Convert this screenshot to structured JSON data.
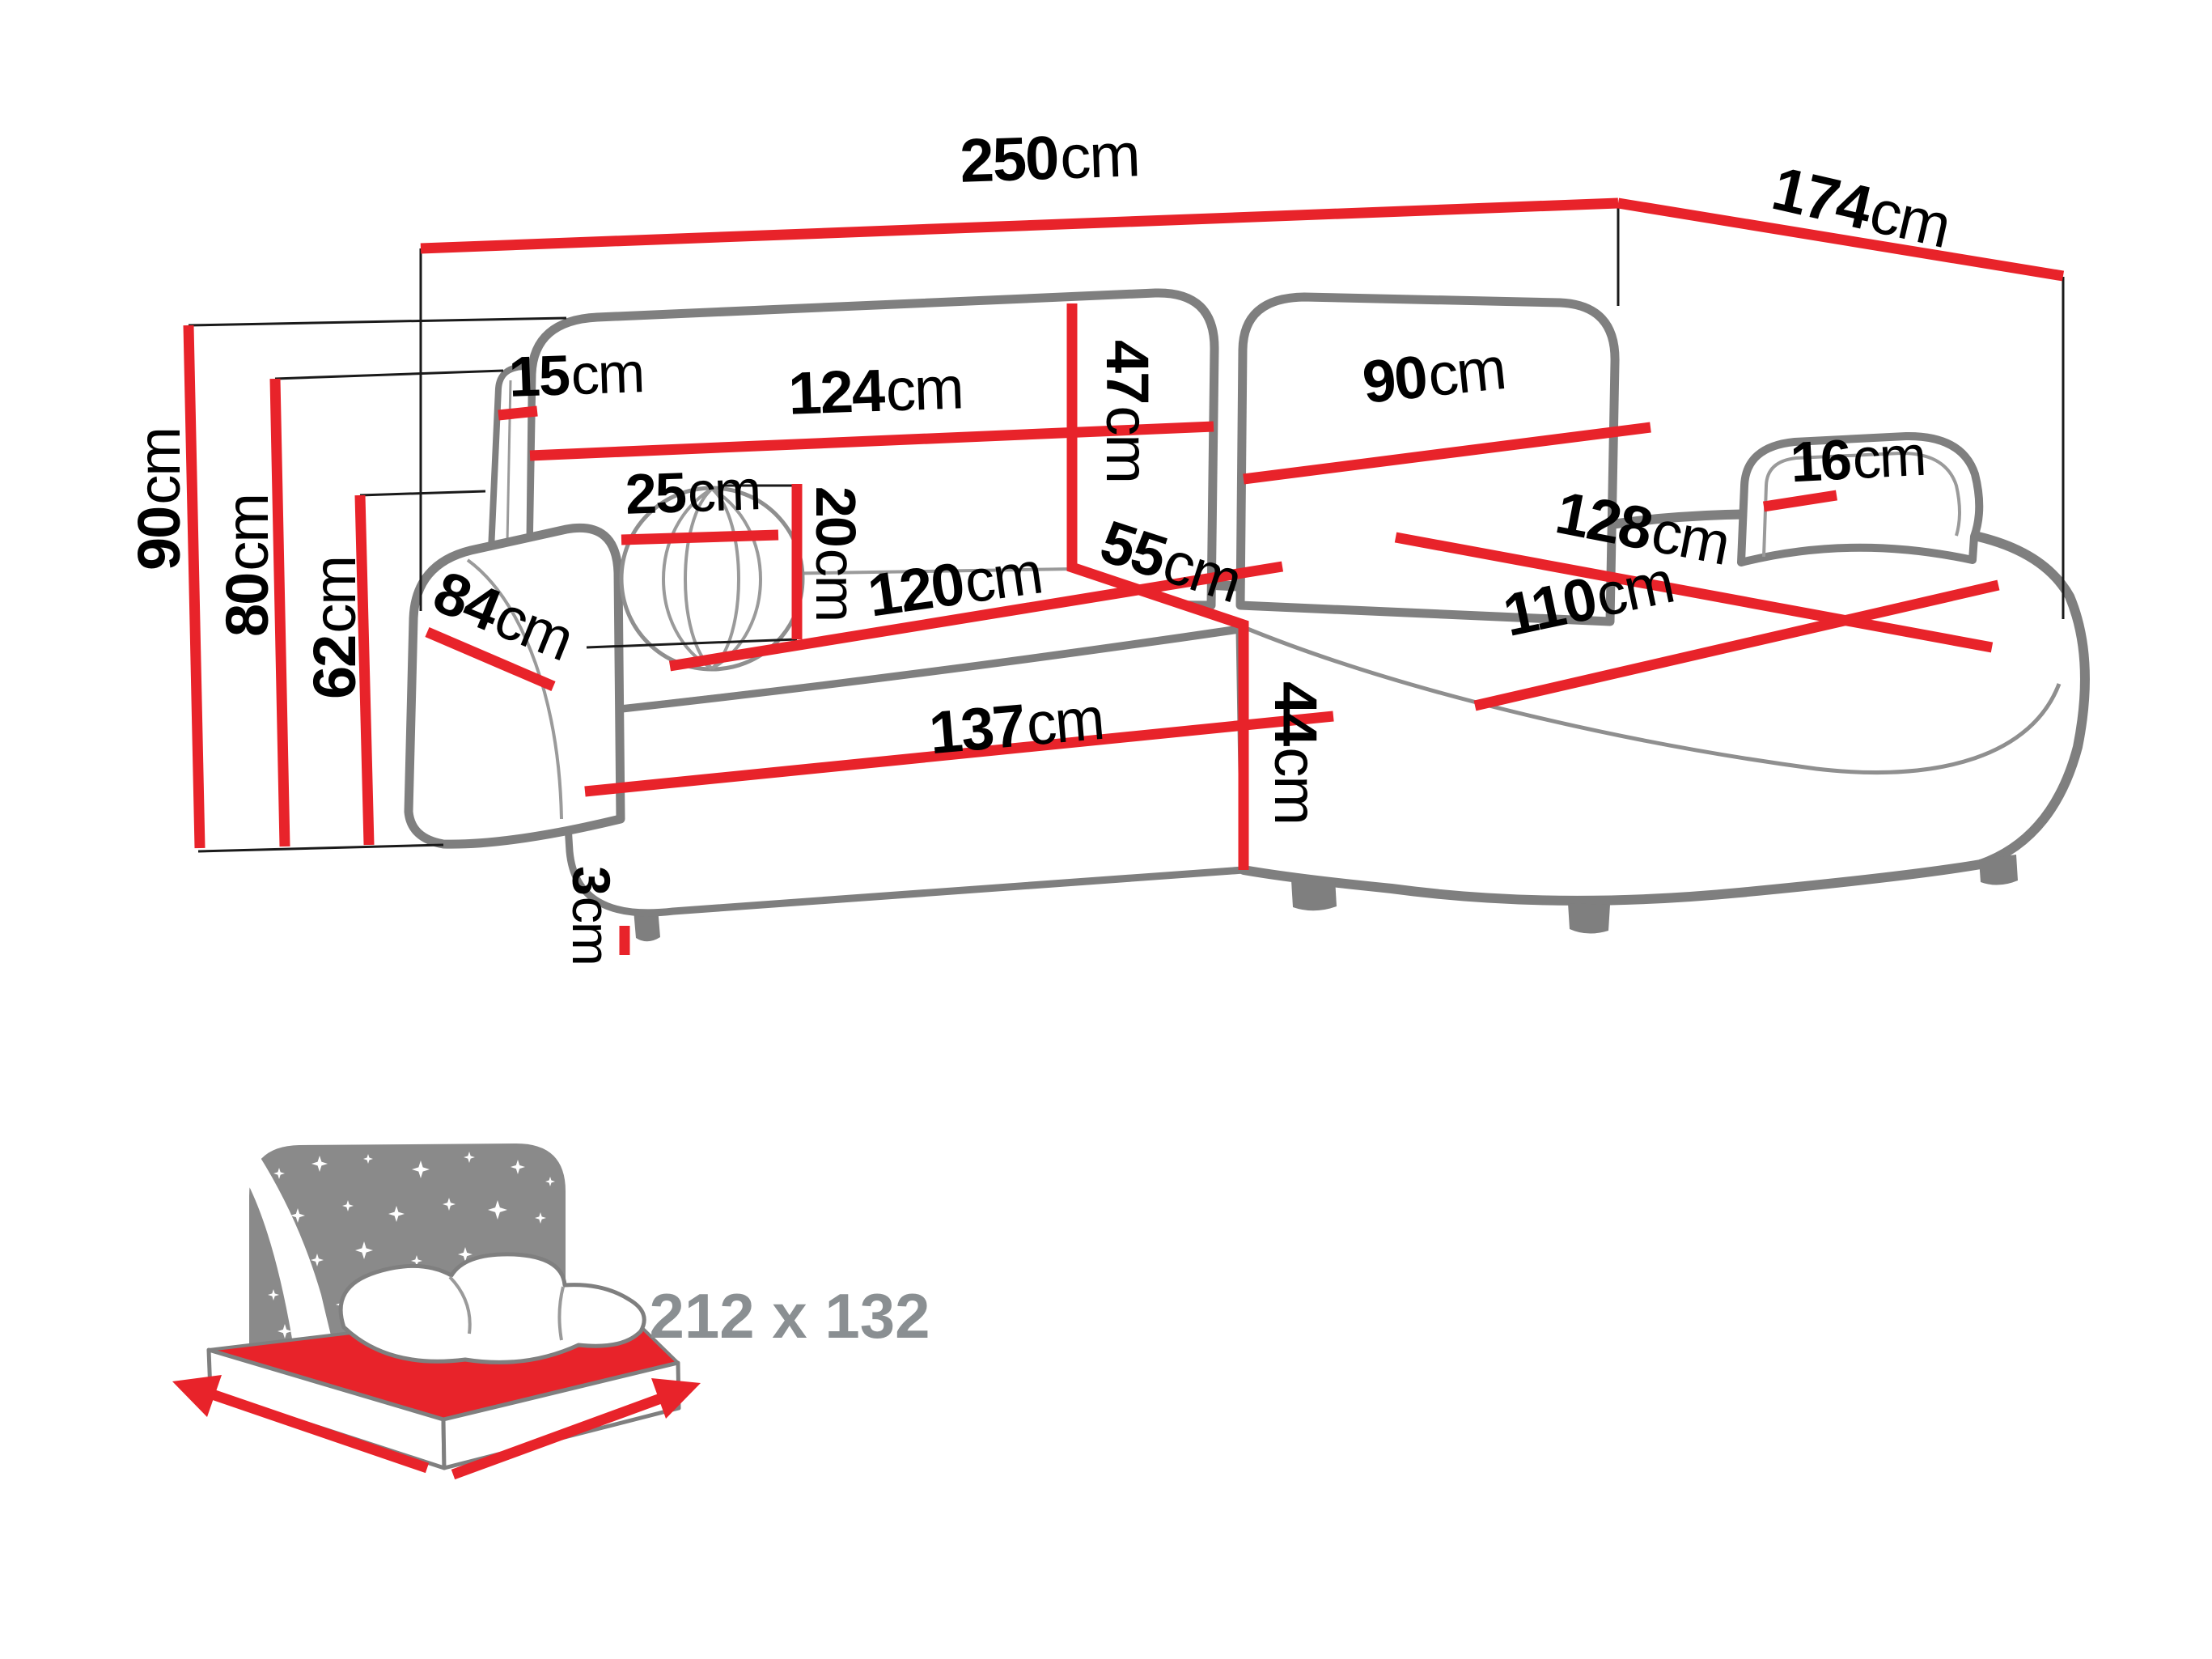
{
  "diagram_title": "corner-sofa-dimension-diagram",
  "colors": {
    "dimension_red": "#e8232a",
    "outline_gray": "#7f7f7f",
    "icon_gray": "#8a8a8a",
    "text_black": "#000000",
    "sleep_text_gray": "#8a8f92"
  },
  "dims": {
    "overall_width": {
      "value": "250",
      "unit": "cm"
    },
    "overall_depth": {
      "value": "174",
      "unit": "cm"
    },
    "total_height": {
      "value": "90",
      "unit": "cm"
    },
    "backrest_height": {
      "value": "80",
      "unit": "cm"
    },
    "armrest_height": {
      "value": "62",
      "unit": "cm"
    },
    "headrest_width": {
      "value": "15",
      "unit": "cm"
    },
    "backrest_left_width": {
      "value": "124",
      "unit": "cm"
    },
    "backrest_inner_height": {
      "value": "47",
      "unit": "cm"
    },
    "backrest_right_width": {
      "value": "90",
      "unit": "cm"
    },
    "armrest_right_width": {
      "value": "16",
      "unit": "cm"
    },
    "pillow_diameter": {
      "value": "25",
      "unit": "cm"
    },
    "pillow_height": {
      "value": "20",
      "unit": "cm"
    },
    "seat_width_left": {
      "value": "120",
      "unit": "cm"
    },
    "corner_seat_depth": {
      "value": "55",
      "unit": "cm"
    },
    "chaise_length": {
      "value": "128",
      "unit": "cm"
    },
    "chaise_width": {
      "value": "110",
      "unit": "cm"
    },
    "armrest_depth": {
      "value": "84",
      "unit": "cm"
    },
    "base_width": {
      "value": "137",
      "unit": "cm"
    },
    "base_height": {
      "value": "44",
      "unit": "cm"
    },
    "leg_height": {
      "value": "3",
      "unit": "cm"
    }
  },
  "sleeping_area": {
    "value": "212 x 132"
  }
}
